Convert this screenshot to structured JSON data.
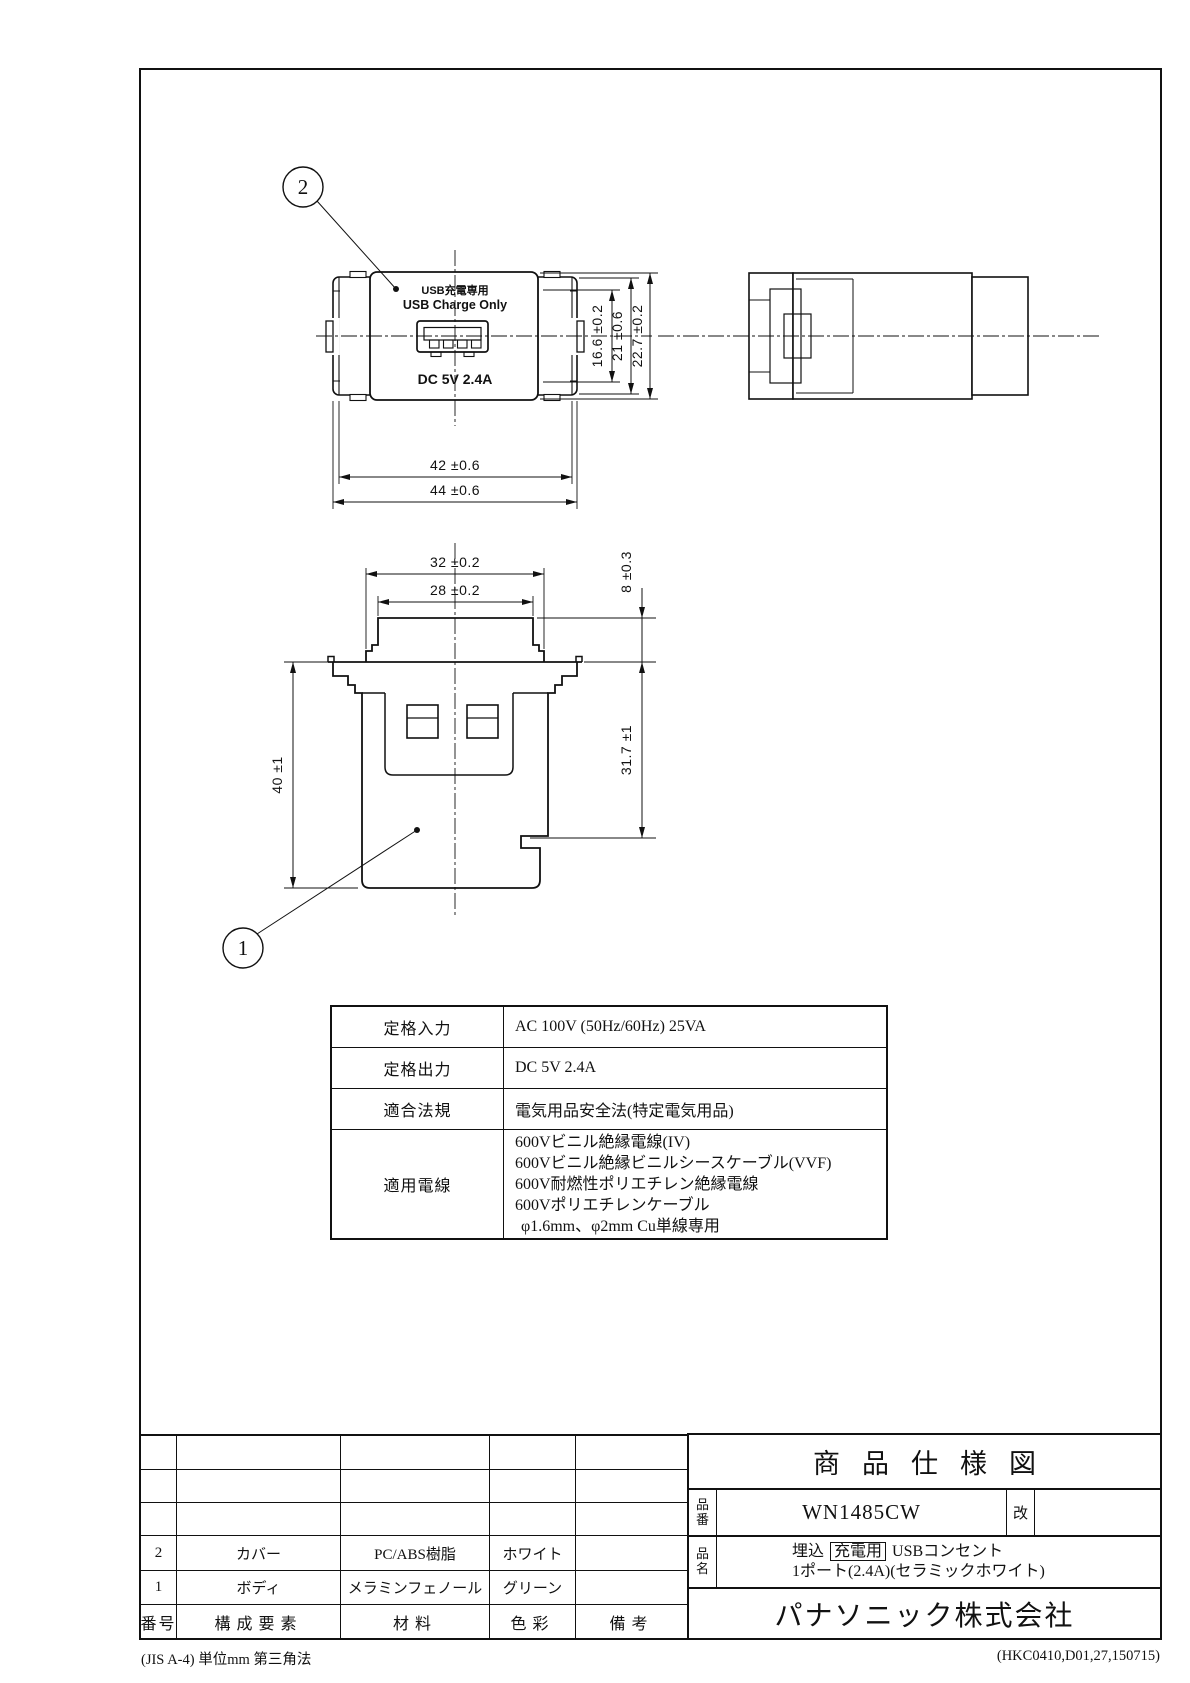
{
  "callouts": {
    "c1": "1",
    "c2": "2"
  },
  "front_view": {
    "label_jp": "USB充電専用",
    "label_en": "USB Charge Only",
    "label_rating": "DC 5V 2.4A",
    "dim_width_inner": "42 ±0.6",
    "dim_width_outer": "44 ±0.6",
    "dim_height_opening": "16.6 ±0.2",
    "dim_height_mid": "21 ±0.6",
    "dim_height_total": "22.7 ±0.2"
  },
  "rear_view": {
    "dim_top_outer": "32 ±0.2",
    "dim_top_inner": "28 ±0.2",
    "dim_protrusion": "8 ±0.3",
    "dim_body_depth": "31.7 ±1",
    "dim_total_depth": "40 ±1"
  },
  "spec_table": {
    "rows": [
      {
        "label": "定格入力",
        "value": "AC 100V (50Hz/60Hz) 25VA"
      },
      {
        "label": "定格出力",
        "value": "DC 5V 2.4A"
      },
      {
        "label": "適合法規",
        "value": "電気用品安全法(特定電気用品)"
      },
      {
        "label": "適用電線",
        "value_lines": [
          "600Vビニル絶縁電線(IV)",
          "600Vビニル絶縁ビニルシースケーブル(VVF)",
          "600V耐燃性ポリエチレン絶縁電線",
          "600Vポリエチレンケーブル",
          "φ1.6mm、φ2mm  Cu単線専用"
        ]
      }
    ]
  },
  "parts_table": {
    "headers": [
      "番号",
      "構成要素",
      "材料",
      "色彩",
      "備考"
    ],
    "rows": [
      {
        "no": "2",
        "component": "カバー",
        "material": "PC/ABS樹脂",
        "color": "ホワイト",
        "note": ""
      },
      {
        "no": "1",
        "component": "ボディ",
        "material": "メラミンフェノール",
        "color": "グリーン",
        "note": ""
      }
    ]
  },
  "title_block": {
    "title": "商品仕様図",
    "part_no_label": "品番",
    "part_no": "WN1485CW",
    "rev_label": "改",
    "part_name_label": "品名",
    "part_name_line1_prefix": "埋込",
    "part_name_line1_boxed": "充電用",
    "part_name_line1_suffix": "USBコンセント",
    "part_name_line2": "1ポート(2.4A)(セラミックホワイト)",
    "company": "パナソニック株式会社"
  },
  "footer": {
    "left": "(JIS A-4)  単位mm  第三角法",
    "right": "(HKC0410,D01,27,150715)"
  }
}
